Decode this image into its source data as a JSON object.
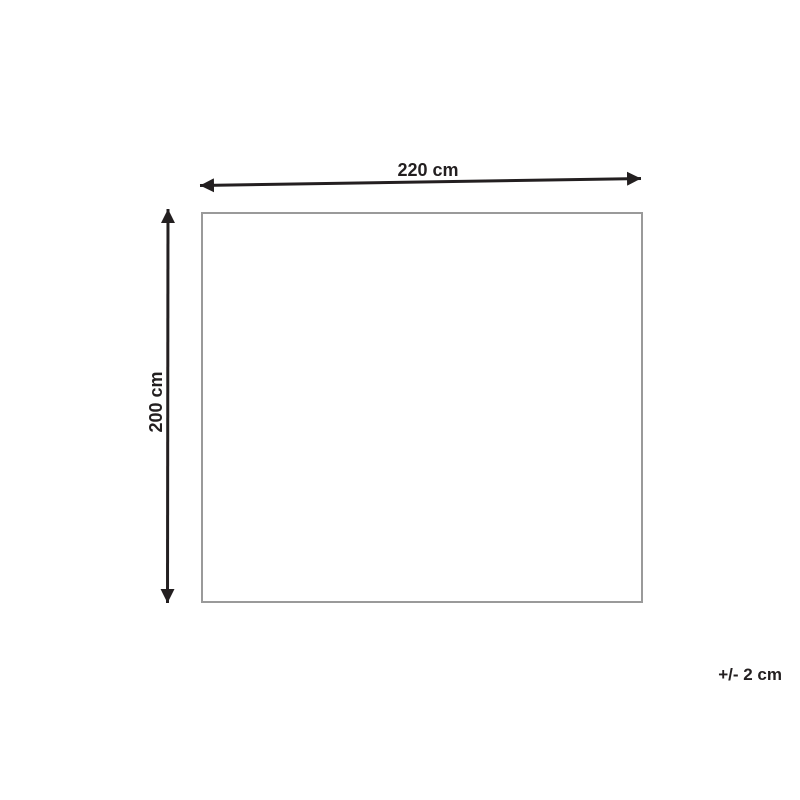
{
  "diagram": {
    "width_label": "220 cm",
    "height_label": "200 cm",
    "tolerance_label": "+/- 2 cm",
    "colors": {
      "arrow_and_text": "#231f20",
      "outline_border": "#9a9a9a",
      "background": "#ffffff"
    },
    "icons": {
      "horizontal_arrow": "double-headed-arrow-horizontal",
      "vertical_arrow": "double-headed-arrow-vertical"
    }
  }
}
